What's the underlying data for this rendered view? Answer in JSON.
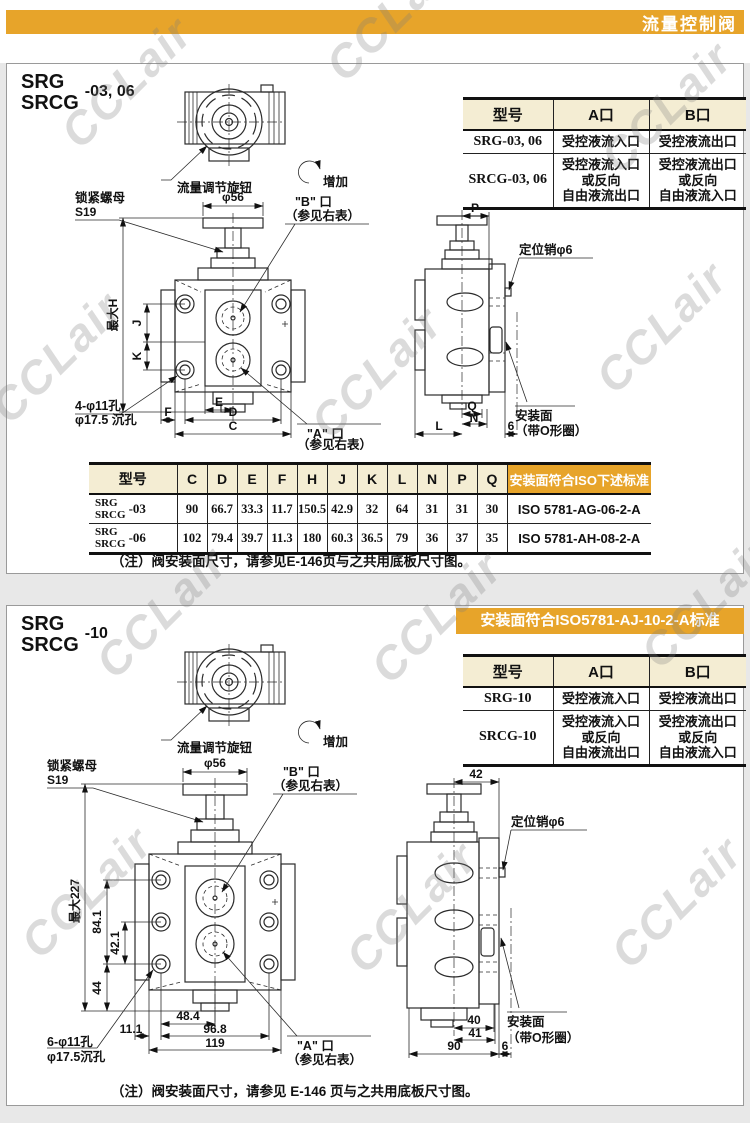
{
  "page": {
    "header_title": "流量控制阀",
    "watermark": "CCLair"
  },
  "s1": {
    "model_line1": "SRG",
    "model_line2": "SRCG",
    "model_suffix": "-03, 06",
    "knob_label": "流量调节旋钮",
    "increase_label": "增加",
    "port_table": {
      "headers": [
        "型号",
        "A口",
        "B口"
      ],
      "rows": [
        {
          "model": "SRG-03, 06",
          "a": "受控液流入口",
          "b": "受控液流出口"
        },
        {
          "model": "SRCG-03, 06",
          "a": "受控液流入口\n或反向\n自由液流出口",
          "b": "受控液流出口\n或反向\n自由液流入口"
        }
      ]
    },
    "front_view": {
      "lock_nut_label": "锁紧螺母",
      "lock_nut_size": "S19",
      "dia_label": "φ56",
      "port_b_label": "\"B\" 口",
      "see_table_note": "（参见右表）",
      "port_a_label": "\"A\" 口",
      "dim_h": "最大H",
      "dim_j": "J",
      "dim_k": "K",
      "holes_line1": "4-φ11孔",
      "holes_line2": "φ17.5 沉孔",
      "dim_e": "E",
      "dim_f": "F",
      "dim_d": "D",
      "dim_c": "C"
    },
    "side_view": {
      "dim_p": "P",
      "pin_label": "定位销φ6",
      "dim_q": "Q",
      "dim_n": "N",
      "dim_l": "L",
      "dim_6": "6",
      "mount_line1": "安装面",
      "mount_line2": "（带O形圈）"
    },
    "dim_table": {
      "headers": [
        "型号",
        "C",
        "D",
        "E",
        "F",
        "H",
        "J",
        "K",
        "L",
        "N",
        "P",
        "Q"
      ],
      "iso_header": "安装面符合ISO下述标准",
      "rows": [
        {
          "model_l1": "SRG",
          "model_l2": "SRCG",
          "suffix": "-03",
          "values": [
            "90",
            "66.7",
            "33.3",
            "11.7",
            "150.5",
            "42.9",
            "32",
            "64",
            "31",
            "31",
            "30"
          ],
          "iso": "ISO 5781-AG-06-2-A"
        },
        {
          "model_l1": "SRG",
          "model_l2": "SRCG",
          "suffix": "-06",
          "values": [
            "102",
            "79.4",
            "39.7",
            "11.3",
            "180",
            "60.3",
            "36.5",
            "79",
            "36",
            "37",
            "35"
          ],
          "iso": "ISO 5781-AH-08-2-A"
        }
      ]
    },
    "note": "（注）阀安装面尺寸，请参见E-146页与之共用底板尺寸图。"
  },
  "s2": {
    "model_line1": "SRG",
    "model_line2": "SRCG",
    "model_suffix": "-10",
    "iso_banner": "安装面符合ISO5781-AJ-10-2-A标准",
    "knob_label": "流量调节旋钮",
    "increase_label": "增加",
    "port_table": {
      "headers": [
        "型号",
        "A口",
        "B口"
      ],
      "rows": [
        {
          "model": "SRG-10",
          "a": "受控液流入口",
          "b": "受控液流出口"
        },
        {
          "model": "SRCG-10",
          "a": "受控液流入口\n或反向\n自由液流出口",
          "b": "受控液流出口\n或反向\n自由液流入口"
        }
      ]
    },
    "front_view": {
      "lock_nut_label": "锁紧螺母",
      "lock_nut_size": "S19",
      "dia_label": "φ56",
      "port_b_label": "\"B\" 口",
      "see_table_note": "（参见右表）",
      "port_a_label": "\"A\" 口",
      "dim_max": "最大227",
      "dim_841": "84.1",
      "dim_421": "42.1",
      "dim_44": "44",
      "holes_line1": "6-φ11孔",
      "holes_line2": "φ17.5沉孔",
      "dim_484": "48.4",
      "dim_111": "11.1",
      "dim_968": "96.8",
      "dim_119": "119"
    },
    "side_view": {
      "dim_42": "42",
      "pin_label": "定位销φ6",
      "dim_40": "40",
      "dim_41": "41",
      "dim_90": "90",
      "dim_6": "6",
      "mount_line1": "安装面",
      "mount_line2": "（带O形圈）"
    },
    "note": "（注）阀安装面尺寸，请参见 E-146 页与之共用底板尺寸图。"
  },
  "colors": {
    "accent_orange": "#e7a42a",
    "table_header_bg": "#f4edd3"
  }
}
